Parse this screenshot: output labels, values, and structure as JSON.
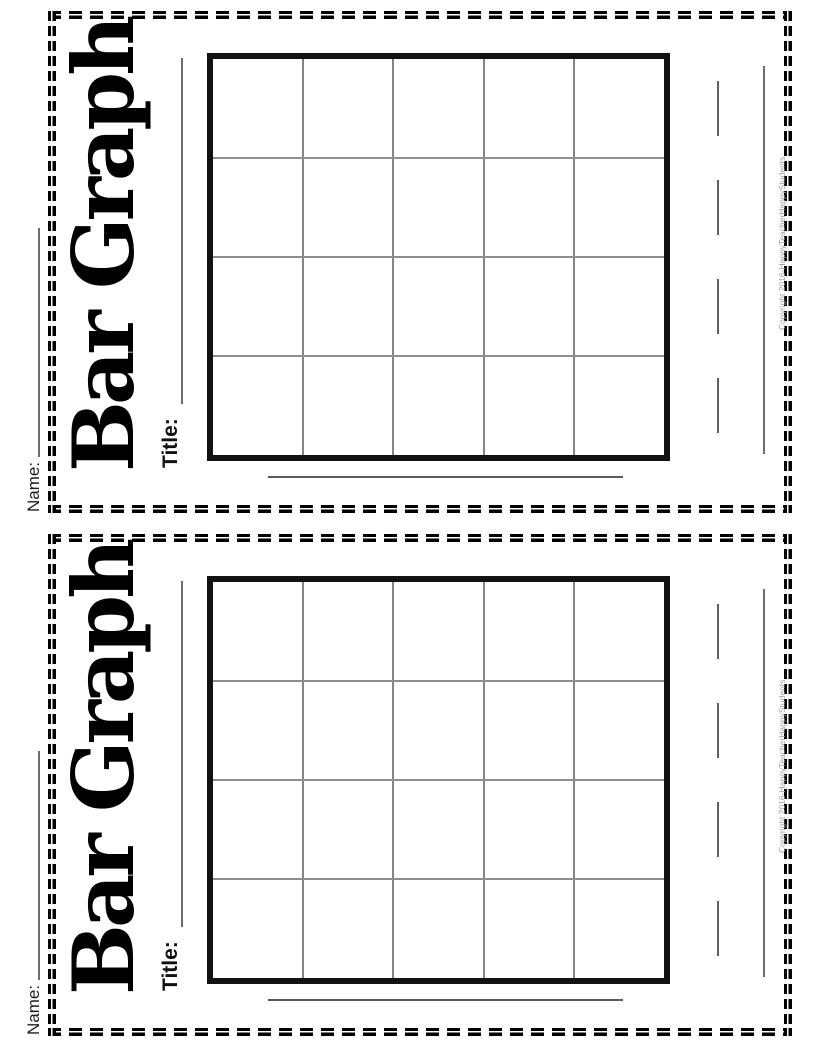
{
  "page": {
    "kind": "printable-worksheet",
    "colors": {
      "border": "#000000",
      "grid_border": "#121212",
      "grid_inner_line": "#888888",
      "writing_line": "#6d6d6d",
      "copyright_text": "#9f9f9f"
    }
  },
  "panels": [
    {
      "title": "Bar Graph",
      "name_label": "Name:",
      "title_label": "Title:",
      "copyright": "Copyright 2016-HappyTeacherHappyStudents",
      "grid": {
        "columns": 5,
        "rows": 4
      }
    },
    {
      "title": "Bar Graph",
      "name_label": "Name:",
      "title_label": "Title:",
      "copyright": "Copyright 2016-HappyTeacherHappyStudents",
      "grid": {
        "columns": 5,
        "rows": 4
      }
    }
  ]
}
